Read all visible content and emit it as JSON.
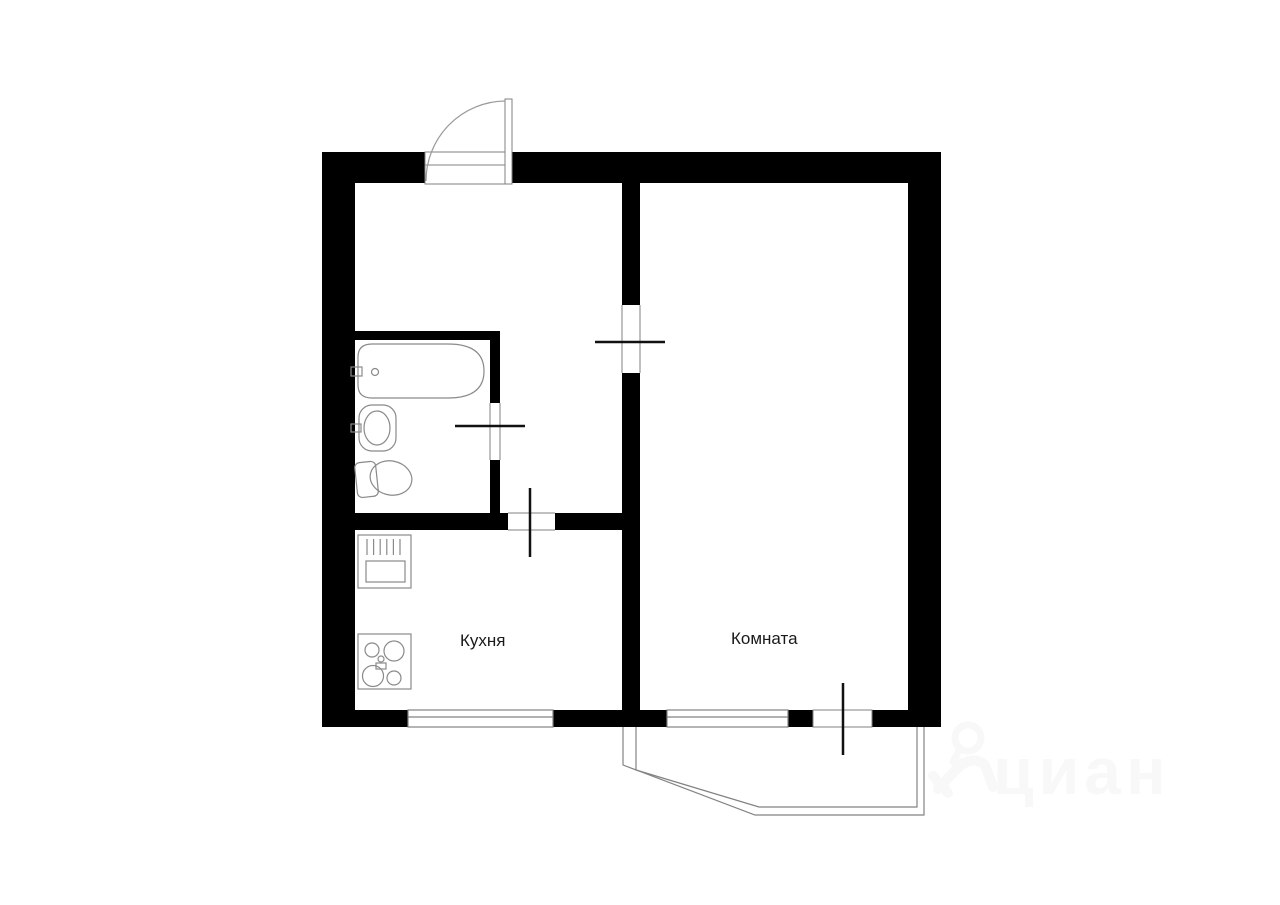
{
  "floor_plan": {
    "labels": {
      "kitchen": "Кухня",
      "room": "Комната"
    },
    "rooms": [
      {
        "id": "kitchen",
        "label": "Кухня"
      },
      {
        "id": "room",
        "label": "Комната"
      }
    ],
    "fixtures": [
      "bathtub",
      "wash-basin",
      "toilet",
      "kitchen-sink",
      "stove",
      "entrance-door",
      "room-door",
      "bathroom-door",
      "kitchen-door",
      "balcony-door",
      "kitchen-window",
      "room-window",
      "balcony"
    ],
    "watermark": {
      "brand": "циан"
    },
    "colors": {
      "wall": "#000000",
      "thin_line": "#828282",
      "door_leaf": "#111111",
      "label_text": "#1a1a1a",
      "watermark": "#f8f8f8",
      "background": "#ffffff"
    }
  }
}
